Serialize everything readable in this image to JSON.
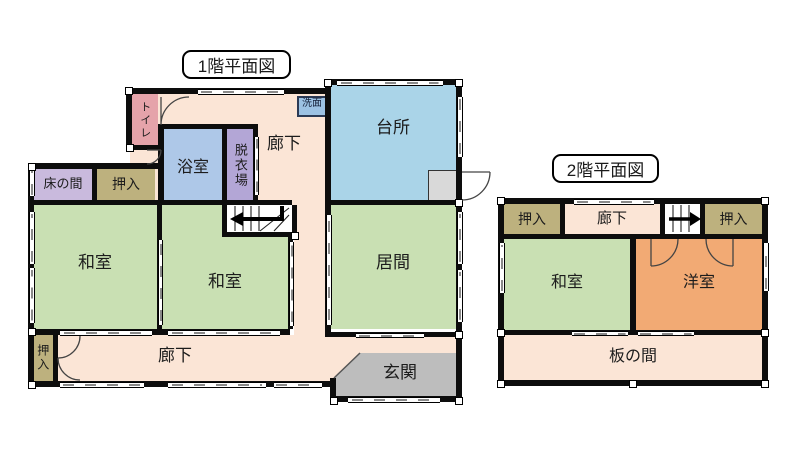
{
  "floor1": {
    "title": "1階平面図",
    "rooms": {
      "toilet": {
        "label": "トイレ"
      },
      "bath": {
        "label": "浴室"
      },
      "dressing": {
        "label": "脱衣場"
      },
      "washstand": {
        "label": "洗面"
      },
      "kitchen": {
        "label": "台所"
      },
      "corridor_top": {
        "label": "廊下"
      },
      "tokonoma": {
        "label": "床の間"
      },
      "closet_top": {
        "label": "押入"
      },
      "washitsu_left": {
        "label": "和室"
      },
      "washitsu_mid": {
        "label": "和室"
      },
      "living": {
        "label": "居間"
      },
      "corridor_bottom": {
        "label": "廊下"
      },
      "closet_bottom": {
        "label": "押入"
      },
      "entrance": {
        "label": "玄関"
      }
    },
    "icons": [
      "stairs-up-bent-left-arrow"
    ]
  },
  "floor2": {
    "title": "2階平面図",
    "rooms": {
      "closet_left": {
        "label": "押入"
      },
      "corridor": {
        "label": "廊下"
      },
      "closet_right": {
        "label": "押入"
      },
      "washitsu": {
        "label": "和室"
      },
      "youshitsu": {
        "label": "洋室"
      },
      "itanoma": {
        "label": "板の間"
      }
    },
    "icons": [
      "stairs-up-right-arrow"
    ]
  },
  "colors": {
    "cream": "#fbe5d6",
    "kitchen_blue": "#aad4e8",
    "bath_blue": "#aec8e8",
    "washstand_blue": "#9cc2e4",
    "dressing_purple": "#b3a6d6",
    "toilet_pink": "#e5a3aa",
    "tokonoma_lavender": "#c9badd",
    "closet_tan": "#bdb17e",
    "tatami_green": "#c9e0b3",
    "entrance_gray": "#bdbdbd",
    "kitchen_box_gray": "#d9d9d9",
    "youshitsu_orange": "#f2aa74",
    "wall_black": "#0d0d0d"
  }
}
